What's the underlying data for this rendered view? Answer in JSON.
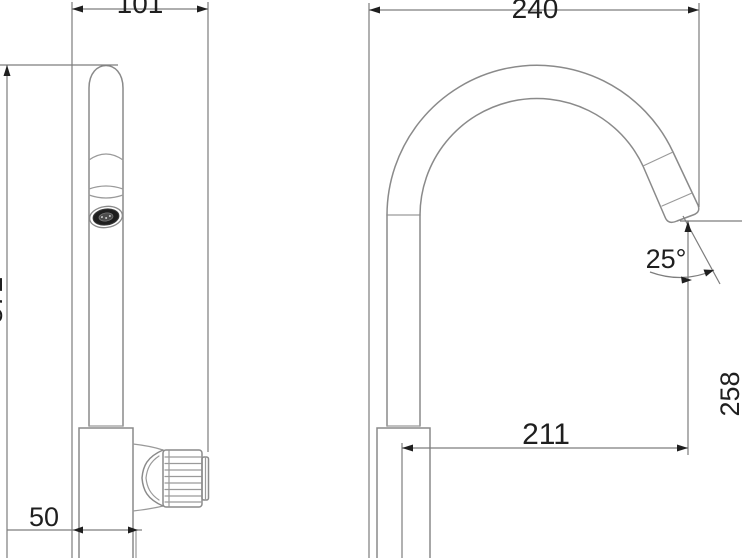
{
  "drawing": {
    "dimensions": {
      "side_width": "101",
      "total_height": "372",
      "base_depth": "50",
      "spout_reach": "240",
      "spout_angle": "25°",
      "outlet_offset": "211",
      "outlet_height": "258"
    }
  }
}
